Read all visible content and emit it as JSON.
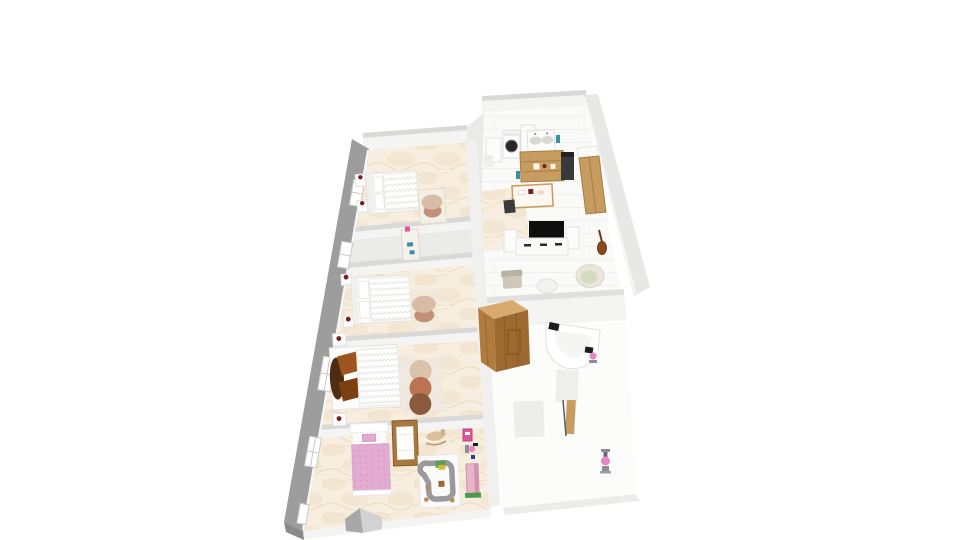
{
  "scene": {
    "kind": "3d-floorplan-render",
    "palette": {
      "page_bg": "#ffffff",
      "exterior_wall": "#9d9d9d",
      "exterior_wall_dark": "#8a8a8a",
      "wall_face": "#f4f4f3",
      "wall_top": "#d9d9d8",
      "wall_band": "#f0f0ef",
      "closet_top": "#eaeae9",
      "marble_base": "#f7eedf",
      "marble_vein": "#ecd9bc",
      "hall_floor": "#ebebe9",
      "white_floor": "#fafaf9",
      "edge_strip": "#ececea",
      "wood": "#c79c60",
      "wood_dark": "#9c6a30",
      "wood_mid": "#b07c3e",
      "wood_light": "#d8aa6e",
      "crib_wood": "#a9783f",
      "white_furniture": "#fdfdfd",
      "furniture_stroke": "#e2e2e0",
      "pouf_top": "#d9bca6",
      "pouf_bottom": "#c09078",
      "rug_base": "#efe8df",
      "rug_circle_top": "#d9c3ab",
      "rug_circle_mid": "#bc7352",
      "rug_circle_bottom": "#8a5a3c",
      "pillow_brown": "#9c5520",
      "pillow_brown_dark": "#7c3f12",
      "headboard_disc": "#4f2c10",
      "accent_dark_red": "#7a1f1f",
      "kids_pink": "#e3abd1",
      "toy_pink": "#e0569a",
      "toy_green": "#4a9c4a",
      "tv_black": "#0e0e0e",
      "appliance_dark": "#3a3a3a",
      "washer_door": "#26262b",
      "bottle_blue": "#3e8ca6",
      "papasan_outer": "#e9e7dc",
      "papasan_inner": "#d6dcc2",
      "armchair": "#cfc8ba",
      "road_gray": "#9a9a9a",
      "figure_pink": "#e487c8",
      "figure_gray": "#8d8d95",
      "guitar_brown": "#8a4a1e",
      "stair_left": "#a8a8a8",
      "stair_right": "#d2d2d2"
    },
    "rooms": [
      {
        "name": "bedroom-top",
        "furniture": [
          "double-bed",
          "bedside-table",
          "bench-mat",
          "pouf-stack"
        ]
      },
      {
        "name": "hallway",
        "furniture": [
          "wardrobe-cabinet"
        ]
      },
      {
        "name": "bedroom-middle",
        "furniture": [
          "double-bed",
          "bedside-tables",
          "pouf-stack"
        ]
      },
      {
        "name": "bedroom-master",
        "furniture": [
          "double-bed",
          "brown-pillows",
          "round-headboard",
          "bedside-tables",
          "three-circle-rug"
        ]
      },
      {
        "name": "kids-room",
        "furniture": [
          "pink-bed",
          "crib",
          "rocking-horse",
          "play-road-rug",
          "toy-cluster",
          "doll-tower",
          "stair-wedge"
        ]
      },
      {
        "name": "kitchen-laundry",
        "furniture": [
          "washing-machine",
          "white-cabinet",
          "fridge",
          "double-sink-vanity",
          "wood-shelving",
          "dark-stove",
          "wood-cabinets",
          "desk",
          "desk-chair",
          "blue-bottles"
        ]
      },
      {
        "name": "living-area",
        "furniture": [
          "tv",
          "media-console",
          "side-cabinets",
          "armchair",
          "round-table",
          "papasan-chair",
          "guitar"
        ]
      },
      {
        "name": "bathroom",
        "furniture": [
          "sauna-cabin",
          "corner-bathtub",
          "shower-panels",
          "wood-door-panel",
          "child-figures"
        ]
      }
    ]
  }
}
